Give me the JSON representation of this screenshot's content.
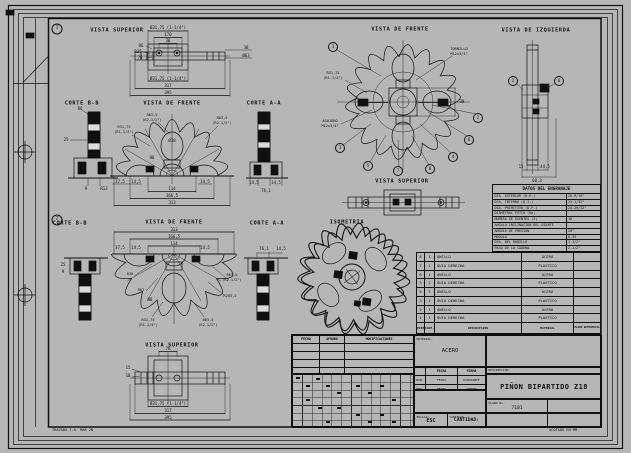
{
  "colors": {
    "ink": "#101010",
    "paper": "#b6b6b6",
    "section_light": "#dcdcdc"
  },
  "notes": {
    "trazado": "TRAZADO J.A. MAR 2N",
    "acotado": "ACOTADO EN MM."
  },
  "markers": {
    "g1": "1",
    "g2": "2"
  },
  "titles": {
    "g1_superior": "VISTA SUPERIOR",
    "g1_corte_bb": "CORTE B-B",
    "g1_frente": "VISTA DE FRENTE",
    "g1_corte_aa": "CORTE A-A",
    "g2_corte_bb": "CORTE B-B",
    "g2_frente": "VISTA DE FRENTE",
    "g2_corte_aa": "CORTE A-A",
    "g2_superior": "VISTA SUPERIOR",
    "fr": "VISTA DE FRENTE",
    "izq": "VISTA DE IZQUIERDA",
    "sup": "VISTA SUPERIOR",
    "iso": "ISOMETRIA"
  },
  "dims": {
    "ts1": [
      "Ø31,75 (1-1/4\")",
      "170",
      "78",
      "R6",
      "R35",
      "76",
      "Ø31,75 (1-1/4\")",
      "317",
      "395",
      "38",
      "Ø63"
    ],
    "cb1": [
      "R6",
      "25",
      "9",
      "R13"
    ],
    "f1": [
      "37,5",
      "14,5",
      "14,5",
      "114",
      "166,5",
      "313",
      "Ø38",
      "H8"
    ],
    "ca1": [
      "14,5",
      "14,5",
      "76,1"
    ],
    "cb2": [
      "25",
      "9"
    ],
    "f2": [
      "313",
      "166,5",
      "114",
      "37,5",
      "14,5",
      "14,5",
      "H8"
    ],
    "ca2": [
      "76,1",
      "14,5"
    ],
    "ts2": [
      "78",
      "Ø31,75 (1-1/4\")",
      "317",
      "395",
      "15",
      "10"
    ],
    "izq": [
      "15",
      "44,5",
      "60,3"
    ],
    "fr": [
      "38"
    ]
  },
  "callouts": {
    "f1_left_top": [
      "R63,5",
      "(R2-1/2\")"
    ],
    "f1_left": [
      "R31,75",
      "(R1-1/4\")"
    ],
    "f1_right": [
      "R63,5",
      "(R2-1/2\")"
    ],
    "f2_r38": "R38",
    "f2_r63": "R63",
    "f2_right2": [
      "R63,5",
      "(R2-1/2\")"
    ],
    "f2_r2032": "R203,2",
    "f2_bot_left": [
      "R31,75",
      "(R1-1/4\")"
    ],
    "f2_bot_right": [
      "Ø63,5",
      "(R2-1/2\")"
    ],
    "fr_tornillo": [
      "TORNILLO",
      "M12x3/4\""
    ],
    "fr_radio": [
      "R31,75",
      "(R1-1/4\")"
    ],
    "fr_agujero": [
      "AGUJERO",
      "M12x3/4\""
    ]
  },
  "balloons": {
    "fr": [
      "1",
      "3",
      "5",
      "7",
      "8",
      "4",
      "6",
      "2"
    ],
    "izq": [
      "2",
      "6"
    ]
  },
  "datos": {
    "title": "DATOS DEL ENGRANAJE",
    "rows": [
      {
        "l": "DIA. EXTERIOR (D.E.)",
        "v": "26-9/16\""
      },
      {
        "l": "DIA. INTERNO (D.I.)",
        "v": "23-1/32\""
      },
      {
        "l": "DIA. PRIMITIVO (D.P.)",
        "v": "24-29/32\""
      },
      {
        "l": "DIAMETRAL PITCH (Dp)",
        "v": ""
      },
      {
        "l": "NUMERO DE DIENTES (Z)",
        "v": "18"
      },
      {
        "l": "ANGULO INCLINACION DEL DIENTE",
        "v": ""
      },
      {
        "l": "ANGULO DE PRESION",
        "v": "20°"
      },
      {
        "l": "MODULO",
        "v": "6,35"
      },
      {
        "l": "DIA. DEL RODILLO",
        "v": "1-1/2\""
      },
      {
        "l": "PASO DE LA CADENA",
        "v": "2-1/2\""
      }
    ]
  },
  "bom": {
    "headers": [
      "PIEZA",
      "CANT.",
      "DESCRIPCION",
      "MATERIAL",
      "PLANO REFERENCIA"
    ],
    "rows": [
      [
        "8",
        "1",
        "ANILLO",
        "ACERO",
        ""
      ],
      [
        "7",
        "1",
        "GUIA DERECHA",
        "PLASTICO",
        ""
      ],
      [
        "6",
        "1",
        "ANILLO",
        "ACERO",
        ""
      ],
      [
        "5",
        "1",
        "GUIA DERECHA",
        "PLASTICO",
        ""
      ],
      [
        "4",
        "1",
        "ANILLO",
        "ACERO",
        ""
      ],
      [
        "3",
        "1",
        "GUIA DERECHA",
        "PLASTICO",
        ""
      ],
      [
        "2",
        "1",
        "ANILLO",
        "ACERO",
        ""
      ],
      [
        "1",
        "1",
        "GUIA DERECHA",
        "PLASTICO",
        ""
      ]
    ]
  },
  "titleblock": {
    "rev_fecha": "FECHA",
    "rev_aprobo": "APROBO",
    "rev_modificaciones": "MODIFICACIONES",
    "material_label": "MATERIAL:",
    "material_value": "ACERO",
    "col_fecha": "FECHA",
    "col_firma": "FIRMA",
    "row_dib": "DIB.",
    "row_dib_fecha": "FECHA",
    "row_dib_firma": "DIBUJANTE",
    "row_rev": "REV.",
    "row_rev_fecha": "FECHA",
    "row_rev_firma": "APROBO",
    "escala_label": "ESCALA:",
    "escala_value": "ESC",
    "cantidad_label": "CANTIDAD",
    "cantidad_value": "CANTIDAD:",
    "descripcion_label": "DESCRIPCION:",
    "descripcion_value": "PIÑON BIPARTIDO Z18",
    "plano_label": "PLANO No.",
    "plano_value": "7101"
  }
}
